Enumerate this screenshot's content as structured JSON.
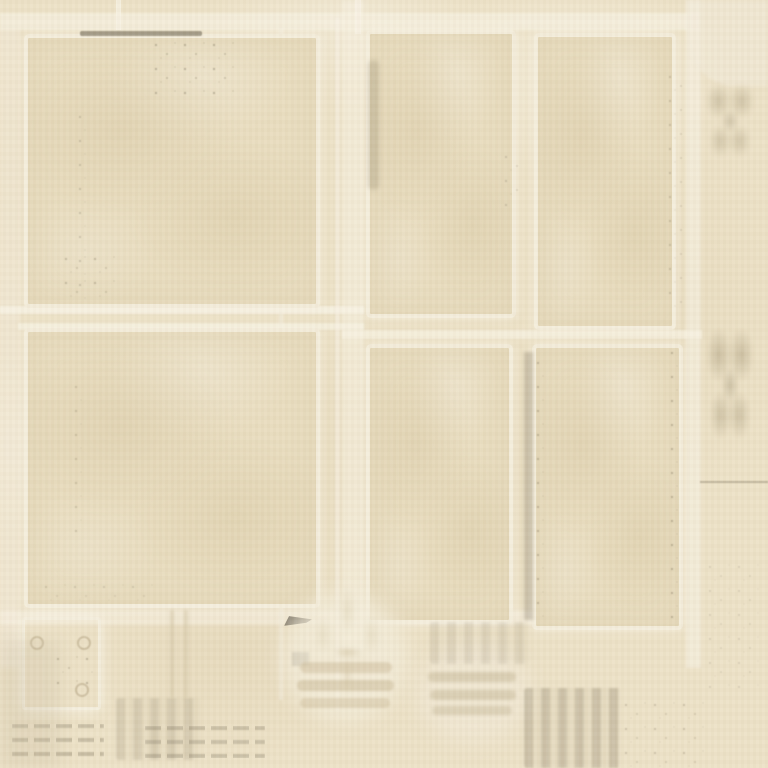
{
  "palette": {
    "paper_base": "#ece1c6",
    "paper_shadow": "#e3d6b4",
    "paper_light_band": "#f6f0de",
    "frame_line": "#f5eeda",
    "panel_fill": "#e8dcbe",
    "stain_soft": "#b5a883",
    "stain_dark": "#6b6350"
  },
  "panels": {
    "top_left": {
      "css": {
        "left": "24px",
        "top": "34px",
        "width": "296px",
        "height": "274px"
      }
    },
    "bottom_left": {
      "css": {
        "left": "24px",
        "top": "328px",
        "width": "296px",
        "height": "280px"
      }
    },
    "top_middle": {
      "css": {
        "left": "366px",
        "top": "30px",
        "width": "150px",
        "height": "288px"
      }
    },
    "bottom_middle": {
      "css": {
        "left": "366px",
        "top": "344px",
        "width": "147px",
        "height": "280px"
      }
    },
    "top_right": {
      "css": {
        "left": "534px",
        "top": "33px",
        "width": "142px",
        "height": "297px"
      }
    },
    "bottom_right": {
      "css": {
        "left": "532px",
        "top": "344px",
        "width": "151px",
        "height": "286px"
      }
    },
    "small_square": {
      "css": {
        "left": "22px",
        "top": "617px",
        "width": "79px",
        "height": "93px"
      }
    }
  },
  "bands": [
    {
      "name": "top-horizontal-light-band",
      "css": {
        "left": "0px",
        "top": "13px",
        "width": "700px",
        "height": "17px",
        "background": "rgba(247,241,225,0.70)",
        "filter": "blur(1px)"
      }
    },
    {
      "name": "left-margin-light-band",
      "css": {
        "left": "0px",
        "top": "28px",
        "width": "20px",
        "height": "640px",
        "background": "rgba(243,236,219,0.45)",
        "filter": "blur(1.5px)"
      }
    },
    {
      "name": "mid-gap-vertical-band",
      "css": {
        "left": "342px",
        "top": "0px",
        "width": "22px",
        "height": "650px",
        "background": "rgba(246,240,224,0.60)",
        "filter": "blur(1.5px)"
      }
    },
    {
      "name": "right-margin-vertical-band",
      "css": {
        "left": "686px",
        "top": "0px",
        "width": "15px",
        "height": "668px",
        "background": "rgba(246,240,224,0.65)",
        "filter": "blur(1px)"
      }
    },
    {
      "name": "left-mid-horizontal-band-upper",
      "css": {
        "left": "0px",
        "top": "306px",
        "width": "364px",
        "height": "8px",
        "background": "rgba(248,242,227,0.80)",
        "filter": "blur(0.7px)"
      }
    },
    {
      "name": "left-mid-horizontal-band-lower",
      "css": {
        "left": "18px",
        "top": "323px",
        "width": "346px",
        "height": "7px",
        "background": "rgba(248,242,227,0.65)",
        "filter": "blur(0.8px)"
      }
    },
    {
      "name": "right-mid-horizontal-band",
      "css": {
        "left": "342px",
        "top": "330px",
        "width": "360px",
        "height": "9px",
        "background": "rgba(248,242,227,0.70)",
        "filter": "blur(0.8px)"
      }
    },
    {
      "name": "bottom-horizontal-light-band",
      "css": {
        "left": "0px",
        "top": "610px",
        "width": "548px",
        "height": "15px",
        "background": "rgba(247,241,226,0.55)",
        "filter": "blur(1.5px)"
      }
    },
    {
      "name": "ghost-vertical-line-inner",
      "css": {
        "left": "279px",
        "top": "28px",
        "width": "4px",
        "height": "672px",
        "background": "rgba(246,240,226,0.50)",
        "filter": "blur(0.8px)"
      }
    },
    {
      "name": "ghost-vertical-line-outer",
      "css": {
        "left": "335px",
        "top": "18px",
        "width": "5px",
        "height": "692px",
        "background": "rgba(247,241,227,0.55)",
        "filter": "blur(0.8px)"
      }
    },
    {
      "name": "top-right-corner-light-patch",
      "css": {
        "left": "688px",
        "top": "0px",
        "width": "80px",
        "height": "86px",
        "background": "rgba(242,235,218,0.55)",
        "borderBottomLeftRadius": "48px",
        "filter": "blur(1.5px)"
      }
    },
    {
      "name": "top-band-vertical-notch",
      "css": {
        "left": "116px",
        "top": "0px",
        "width": "5px",
        "height": "30px",
        "background": "rgba(248,242,228,0.80)"
      }
    },
    {
      "name": "mid-top-vertical-notch",
      "css": {
        "left": "355px",
        "top": "0px",
        "width": "6px",
        "height": "34px",
        "background": "rgba(248,242,228,0.75)"
      }
    }
  ],
  "smudges": [
    {
      "name": "top-border-ink-dash",
      "css": {
        "left": "80px",
        "top": "31px",
        "width": "122px",
        "height": "5px",
        "background": "rgba(95,88,70,0.55)",
        "borderRadius": "2px",
        "filter": "blur(0.6px)"
      }
    },
    {
      "name": "top-left-frame-speckle-cluster",
      "cls": "speckles",
      "css": {
        "left": "150px",
        "top": "38px",
        "width": "88px",
        "height": "58px",
        "opacity": "0.75"
      }
    },
    {
      "name": "left-border-speckles",
      "cls": "speckles",
      "css": {
        "left": "74px",
        "top": "110px",
        "width": "16px",
        "height": "190px",
        "opacity": "0.55"
      }
    },
    {
      "name": "frame-corner-stain",
      "cls": "speckles",
      "css": {
        "left": "60px",
        "top": "252px",
        "width": "56px",
        "height": "52px",
        "opacity": "0.60"
      }
    },
    {
      "name": "panel2-left-border-speckles",
      "cls": "speckles",
      "css": {
        "left": "70px",
        "top": "380px",
        "width": "14px",
        "height": "160px",
        "opacity": "0.45"
      }
    },
    {
      "name": "mid-panel-left-streak",
      "css": {
        "left": "368px",
        "top": "60px",
        "width": "11px",
        "height": "130px",
        "background": "rgba(140,128,100,0.28)",
        "borderRadius": "6px",
        "filter": "blur(2px)"
      }
    },
    {
      "name": "mid-panel-right-corner-stain",
      "cls": "speckles",
      "css": {
        "left": "500px",
        "top": "150px",
        "width": "20px",
        "height": "60px",
        "opacity": "0.50"
      }
    },
    {
      "name": "right-panel-edge-stain",
      "cls": "speckles",
      "css": {
        "left": "664px",
        "top": "70px",
        "width": "18px",
        "height": "240px",
        "opacity": "0.50"
      }
    },
    {
      "name": "bottom-mid-panel-right-streak",
      "css": {
        "left": "524px",
        "top": "352px",
        "width": "9px",
        "height": "268px",
        "background": "rgba(120,110,88,0.30)",
        "filter": "blur(1.5px)"
      }
    },
    {
      "name": "bottom-right-panel-left-speckles",
      "cls": "speckles",
      "css": {
        "left": "532px",
        "top": "356px",
        "width": "13px",
        "height": "262px",
        "opacity": "0.60"
      }
    },
    {
      "name": "bottom-right-panel-right-speckles",
      "cls": "speckles",
      "css": {
        "left": "666px",
        "top": "346px",
        "width": "16px",
        "height": "282px",
        "opacity": "0.65"
      }
    },
    {
      "name": "bottom-left-panel-bottom-speckles",
      "cls": "speckles",
      "css": {
        "left": "40px",
        "top": "580px",
        "width": "120px",
        "height": "26px",
        "opacity": "0.40"
      }
    },
    {
      "name": "chevron-ink-mark",
      "css": {
        "left": "284px",
        "top": "615px",
        "width": "28px",
        "height": "11px",
        "background": "rgba(72,66,52,0.70)",
        "clipPath": "polygon(0 100%, 18% 10%, 100% 40%, 80% 70%, 10% 95%)",
        "filter": "blur(0.4px)"
      }
    },
    {
      "name": "small-ink-square",
      "css": {
        "left": "292px",
        "top": "652px",
        "width": "17px",
        "height": "14px",
        "background": "rgba(98,90,72,0.50)",
        "filter": "blur(1px)"
      }
    },
    {
      "name": "fleur-halo",
      "css": {
        "left": "282px",
        "top": "592px",
        "width": "125px",
        "height": "130px",
        "background": "rgba(243,236,218,0.75)",
        "borderRadius": "50%",
        "filter": "blur(9px)"
      }
    },
    {
      "name": "fleur-de-lis-ornament",
      "cls": "fleur",
      "css": {
        "left": "300px",
        "top": "575px",
        "width": "95px",
        "height": "125px"
      }
    },
    {
      "name": "fleur-base-bar-1",
      "css": {
        "left": "300px",
        "top": "662px",
        "width": "92px",
        "height": "11px",
        "background": "rgba(205,190,156,0.55)",
        "borderRadius": "6px",
        "filter": "blur(1.2px)"
      }
    },
    {
      "name": "fleur-base-bar-2",
      "css": {
        "left": "297px",
        "top": "680px",
        "width": "97px",
        "height": "11px",
        "background": "rgba(205,190,156,0.60)",
        "borderRadius": "6px",
        "filter": "blur(1.2px)"
      }
    },
    {
      "name": "fleur-base-bar-3",
      "css": {
        "left": "300px",
        "top": "698px",
        "width": "90px",
        "height": "10px",
        "background": "rgba(205,190,156,0.50)",
        "borderRadius": "6px",
        "filter": "blur(1.2px)"
      }
    },
    {
      "name": "ghost-stamp-halo",
      "css": {
        "left": "418px",
        "top": "642px",
        "width": "112px",
        "height": "100px",
        "background": "rgba(241,234,216,0.60)",
        "borderRadius": "50%",
        "filter": "blur(10px)"
      }
    },
    {
      "name": "ghost-stamp-bar-1",
      "css": {
        "left": "428px",
        "top": "672px",
        "width": "88px",
        "height": "10px",
        "background": "rgba(193,179,146,0.50)",
        "borderRadius": "6px",
        "filter": "blur(1.8px)"
      }
    },
    {
      "name": "ghost-stamp-bar-2",
      "css": {
        "left": "430px",
        "top": "690px",
        "width": "86px",
        "height": "10px",
        "background": "rgba(193,179,146,0.50)",
        "borderRadius": "6px",
        "filter": "blur(1.8px)"
      }
    },
    {
      "name": "ghost-stamp-bar-3",
      "css": {
        "left": "432px",
        "top": "706px",
        "width": "80px",
        "height": "9px",
        "background": "rgba(193,179,146,0.45)",
        "borderRadius": "6px",
        "filter": "blur(1.8px)"
      }
    },
    {
      "name": "ghost-stamp-block-upper",
      "cls": "stripes",
      "css": {
        "left": "430px",
        "top": "622px",
        "width": "100px",
        "height": "42px",
        "opacity": "0.40"
      }
    },
    {
      "name": "ghost-text-rows-left",
      "cls": "dashrow",
      "css": {
        "left": "12px",
        "top": "724px",
        "width": "92px",
        "height": "34px",
        "opacity": "0.55"
      }
    },
    {
      "name": "ghost-text-rows-mid",
      "cls": "dashrow",
      "css": {
        "left": "145px",
        "top": "726px",
        "width": "120px",
        "height": "32px",
        "opacity": "0.50"
      }
    },
    {
      "name": "ghost-pill-block",
      "cls": "stripes",
      "css": {
        "left": "116px",
        "top": "698px",
        "width": "84px",
        "height": "62px",
        "opacity": "0.50"
      }
    },
    {
      "name": "bottom-right-dense-stain",
      "cls": "stripes",
      "css": {
        "left": "524px",
        "top": "688px",
        "width": "96px",
        "height": "80px",
        "opacity": "0.75",
        "filter": "blur(1px)"
      }
    },
    {
      "name": "bottom-right-mottle",
      "cls": "speckles",
      "css": {
        "left": "620px",
        "top": "698px",
        "width": "86px",
        "height": "70px",
        "opacity": "0.50"
      }
    },
    {
      "name": "right-margin-stain-top",
      "cls": "blotch",
      "css": {
        "left": "698px",
        "top": "68px",
        "width": "64px",
        "height": "118px",
        "opacity": "0.80"
      }
    },
    {
      "name": "right-margin-stain-mid",
      "cls": "blotch",
      "css": {
        "left": "699px",
        "top": "305px",
        "width": "62px",
        "height": "178px",
        "opacity": "0.90"
      }
    },
    {
      "name": "right-margin-rule-line",
      "css": {
        "left": "700px",
        "top": "481px",
        "width": "68px",
        "height": "2px",
        "background": "rgba(125,114,92,0.40)",
        "filter": "blur(0.5px)"
      }
    },
    {
      "name": "right-margin-lower-marks",
      "cls": "speckles",
      "css": {
        "left": "704px",
        "top": "560px",
        "width": "56px",
        "height": "130px",
        "opacity": "0.35"
      }
    },
    {
      "name": "square-rivet-1",
      "cls": "rivet",
      "css": {
        "left": "30px",
        "top": "636px",
        "width": "14px",
        "height": "14px"
      }
    },
    {
      "name": "square-rivet-2",
      "cls": "rivet",
      "css": {
        "left": "77px",
        "top": "636px",
        "width": "14px",
        "height": "14px"
      }
    },
    {
      "name": "square-rivet-3",
      "cls": "rivet",
      "css": {
        "left": "75px",
        "top": "683px",
        "width": "14px",
        "height": "14px"
      }
    },
    {
      "name": "square-interior-speckles",
      "cls": "speckles",
      "css": {
        "left": "52px",
        "top": "652px",
        "width": "42px",
        "height": "38px",
        "opacity": "0.70"
      }
    },
    {
      "name": "ghost-double-streak",
      "css": {
        "left": "170px",
        "top": "610px",
        "width": "18px",
        "height": "88px",
        "borderLeft": "4px solid rgba(210,196,165,0.60)",
        "borderRight": "4px solid rgba(210,196,165,0.60)",
        "boxSizing": "border-box",
        "filter": "blur(1.5px)"
      }
    },
    {
      "name": "bottom-left-corner-shade",
      "css": {
        "left": "0px",
        "top": "640px",
        "width": "60px",
        "height": "128px",
        "background": "rgba(196,184,156,0.25)",
        "filter": "blur(8px)"
      }
    }
  ]
}
